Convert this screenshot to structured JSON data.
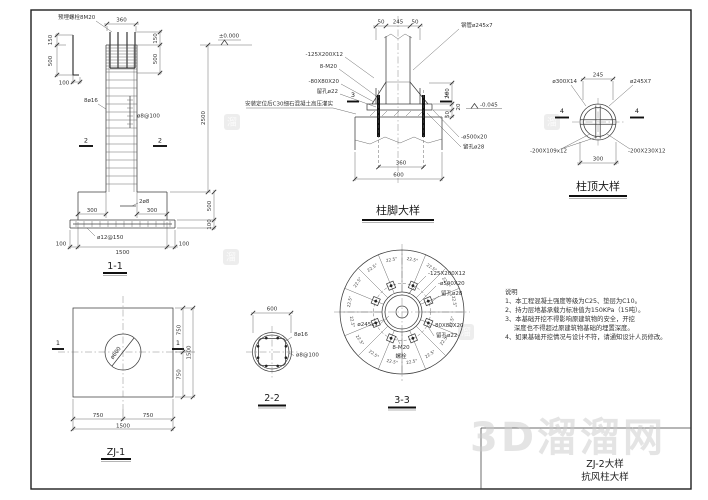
{
  "title_block": {
    "line1": "ZJ-2大样",
    "line2": "抗风柱大样"
  },
  "watermark": {
    "badge": "溜",
    "site": "3D溜溜网"
  },
  "notes": {
    "heading": "说明",
    "line1": "1、本工程混凝土强度等级为C25、垫层为C10。",
    "line2": "2、持力层地基承载力标准值为150KPa（15吨）。",
    "line3": "3、本基础开挖不得影响原建筑物的安全，开挖",
    "line3b": "深度也不得超过原建筑物基础的埋置深度。",
    "line4": "4、如果基础开挖情况与设计不符，请通知设计人员修改。"
  },
  "v11": {
    "title": "1-1",
    "embed_bolt": "预埋螺栓8M20",
    "dim_360": "360",
    "dim_150": "150",
    "dim_500": "500",
    "dim_100": "100",
    "level_zero": "±0.000",
    "rebar_main": "8ø16",
    "stirrup": "ø8@100",
    "dim_2500": "2500",
    "sec2": "2",
    "rebar_2d8": "2ø8",
    "dim_300": "300",
    "mesh": "ø12@150",
    "dim_1500": "1500"
  },
  "vzj1": {
    "title": "ZJ-1",
    "circle": "ø600",
    "sec1": "1",
    "dim_750": "750",
    "dim_1500": "1500"
  },
  "vbase": {
    "title": "柱脚大样",
    "dim_50": "50",
    "dim_245": "245",
    "tube": "钢管ø245x7",
    "plate1": "-125X200X12",
    "bolts": "8-M20",
    "washer": "-80X80X20",
    "hole22": "留孔ø22",
    "grout": "安装定位后C30细石混凝土高压灌实",
    "sec3": "3",
    "dim_200": "200",
    "dim_20": "20",
    "dim_50v": "50",
    "level": "-0.045",
    "plate500": "-ø500x20",
    "hole28": "留孔ø28",
    "dim_360": "360",
    "dim_600": "600"
  },
  "vtop": {
    "title": "柱顶大样",
    "dim_245": "245",
    "dim_300": "300",
    "ring": "ø300X14",
    "tube": "ø245X7",
    "plate_l": "-200X109x12",
    "plate_r": "-200X230X12",
    "sec4": "4"
  },
  "v22": {
    "title": "2-2",
    "dim_600": "600",
    "rebar": "8ø16",
    "stirrup": "ø8@100"
  },
  "v33": {
    "title": "3-3",
    "angle": "22.5°",
    "plate1": "-125X200X12",
    "plate500": "-ø500X20",
    "hole28": "留孔ø28",
    "tube": "ø245x7",
    "washer": "-80X80X20",
    "hole22": "留孔ø22",
    "bolts": "8-M20",
    "bolt_word": "螺栓"
  }
}
